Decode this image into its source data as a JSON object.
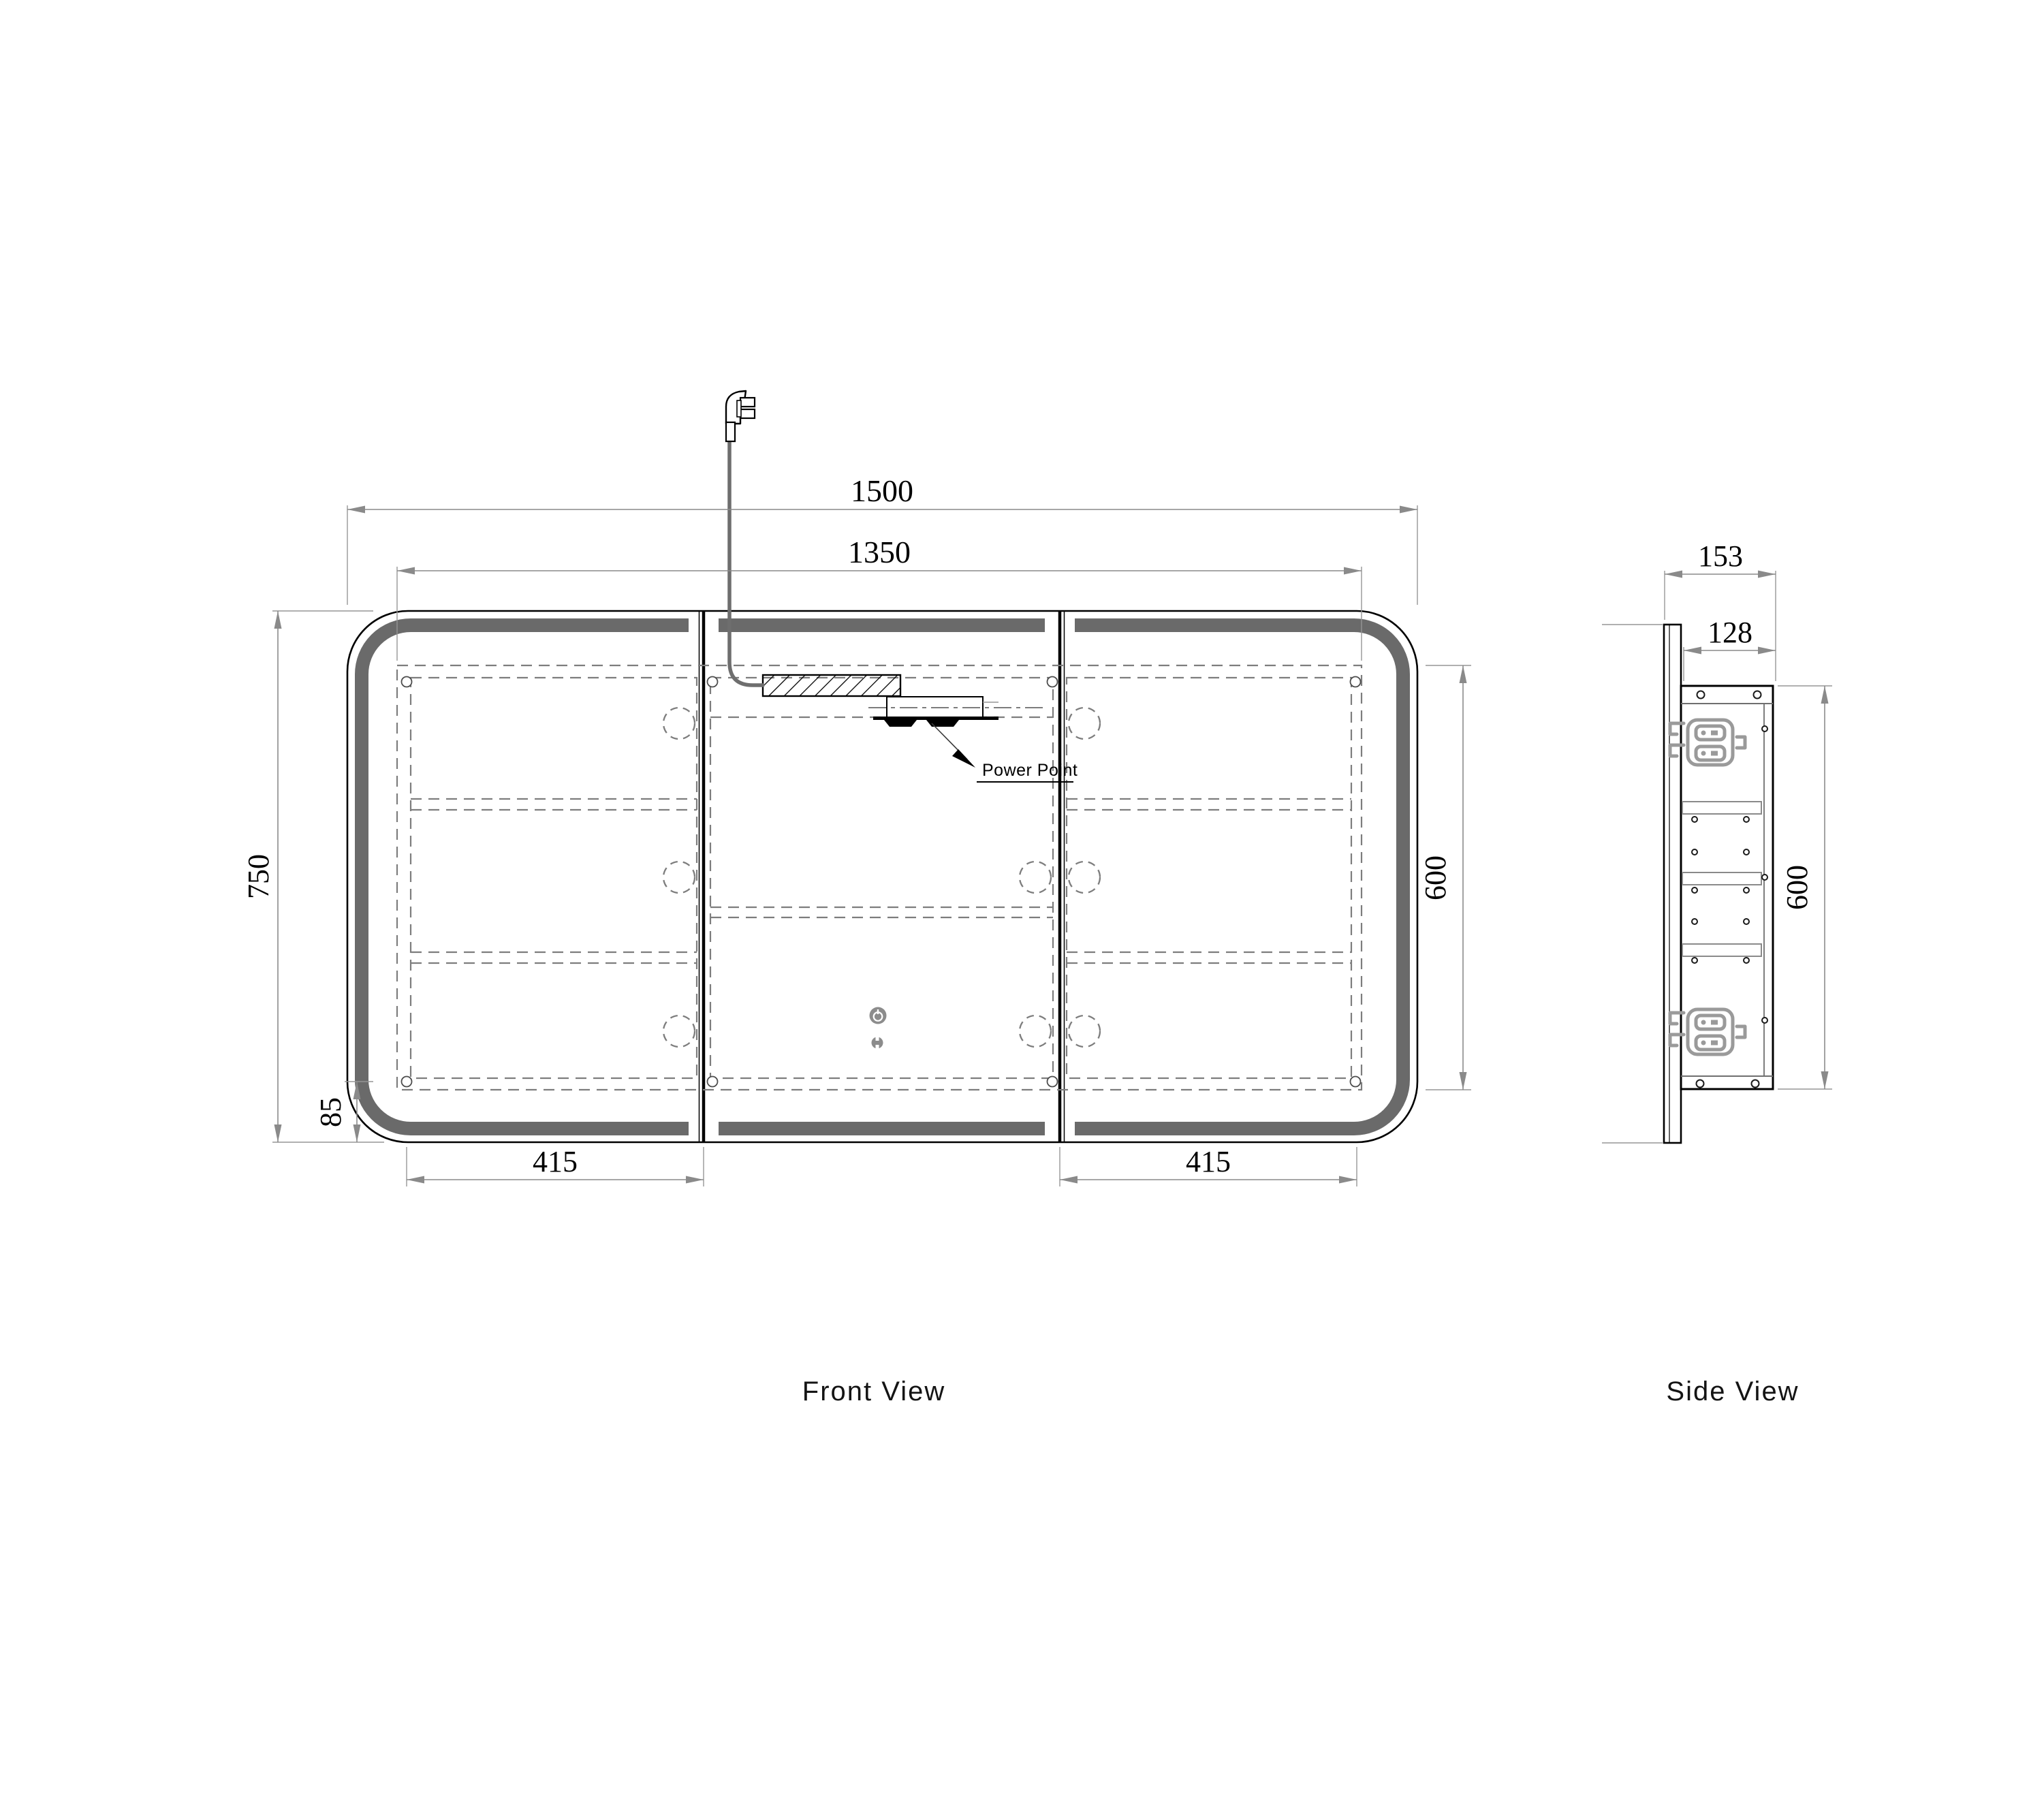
{
  "drawing": {
    "front_view": {
      "title": "Front View",
      "dimensions": {
        "overall_width_mm": "1500",
        "internal_width_mm": "1350",
        "overall_height_mm": "750",
        "corner_radius_mm": "85",
        "left_door_width_mm": "415",
        "right_door_width_mm": "415",
        "internal_height_mm": "600"
      },
      "callouts": {
        "power_point": "Power Point"
      }
    },
    "side_view": {
      "title": "Side View",
      "dimensions": {
        "overall_depth_mm": "153",
        "body_depth_mm": "128",
        "body_height_mm": "600"
      }
    },
    "colors": {
      "outline": "#000000",
      "dimension_line": "#8a8a8a",
      "led_band": "#6a6a6a",
      "hidden_line": "#7d7d7d",
      "bracket": "#9a9a9a",
      "touch_button": "#8c8c8c"
    },
    "icons": {
      "plug": "power-plug-icon",
      "touch_button": "power-button-icon",
      "sensor": "touch-sensor-icon"
    }
  }
}
